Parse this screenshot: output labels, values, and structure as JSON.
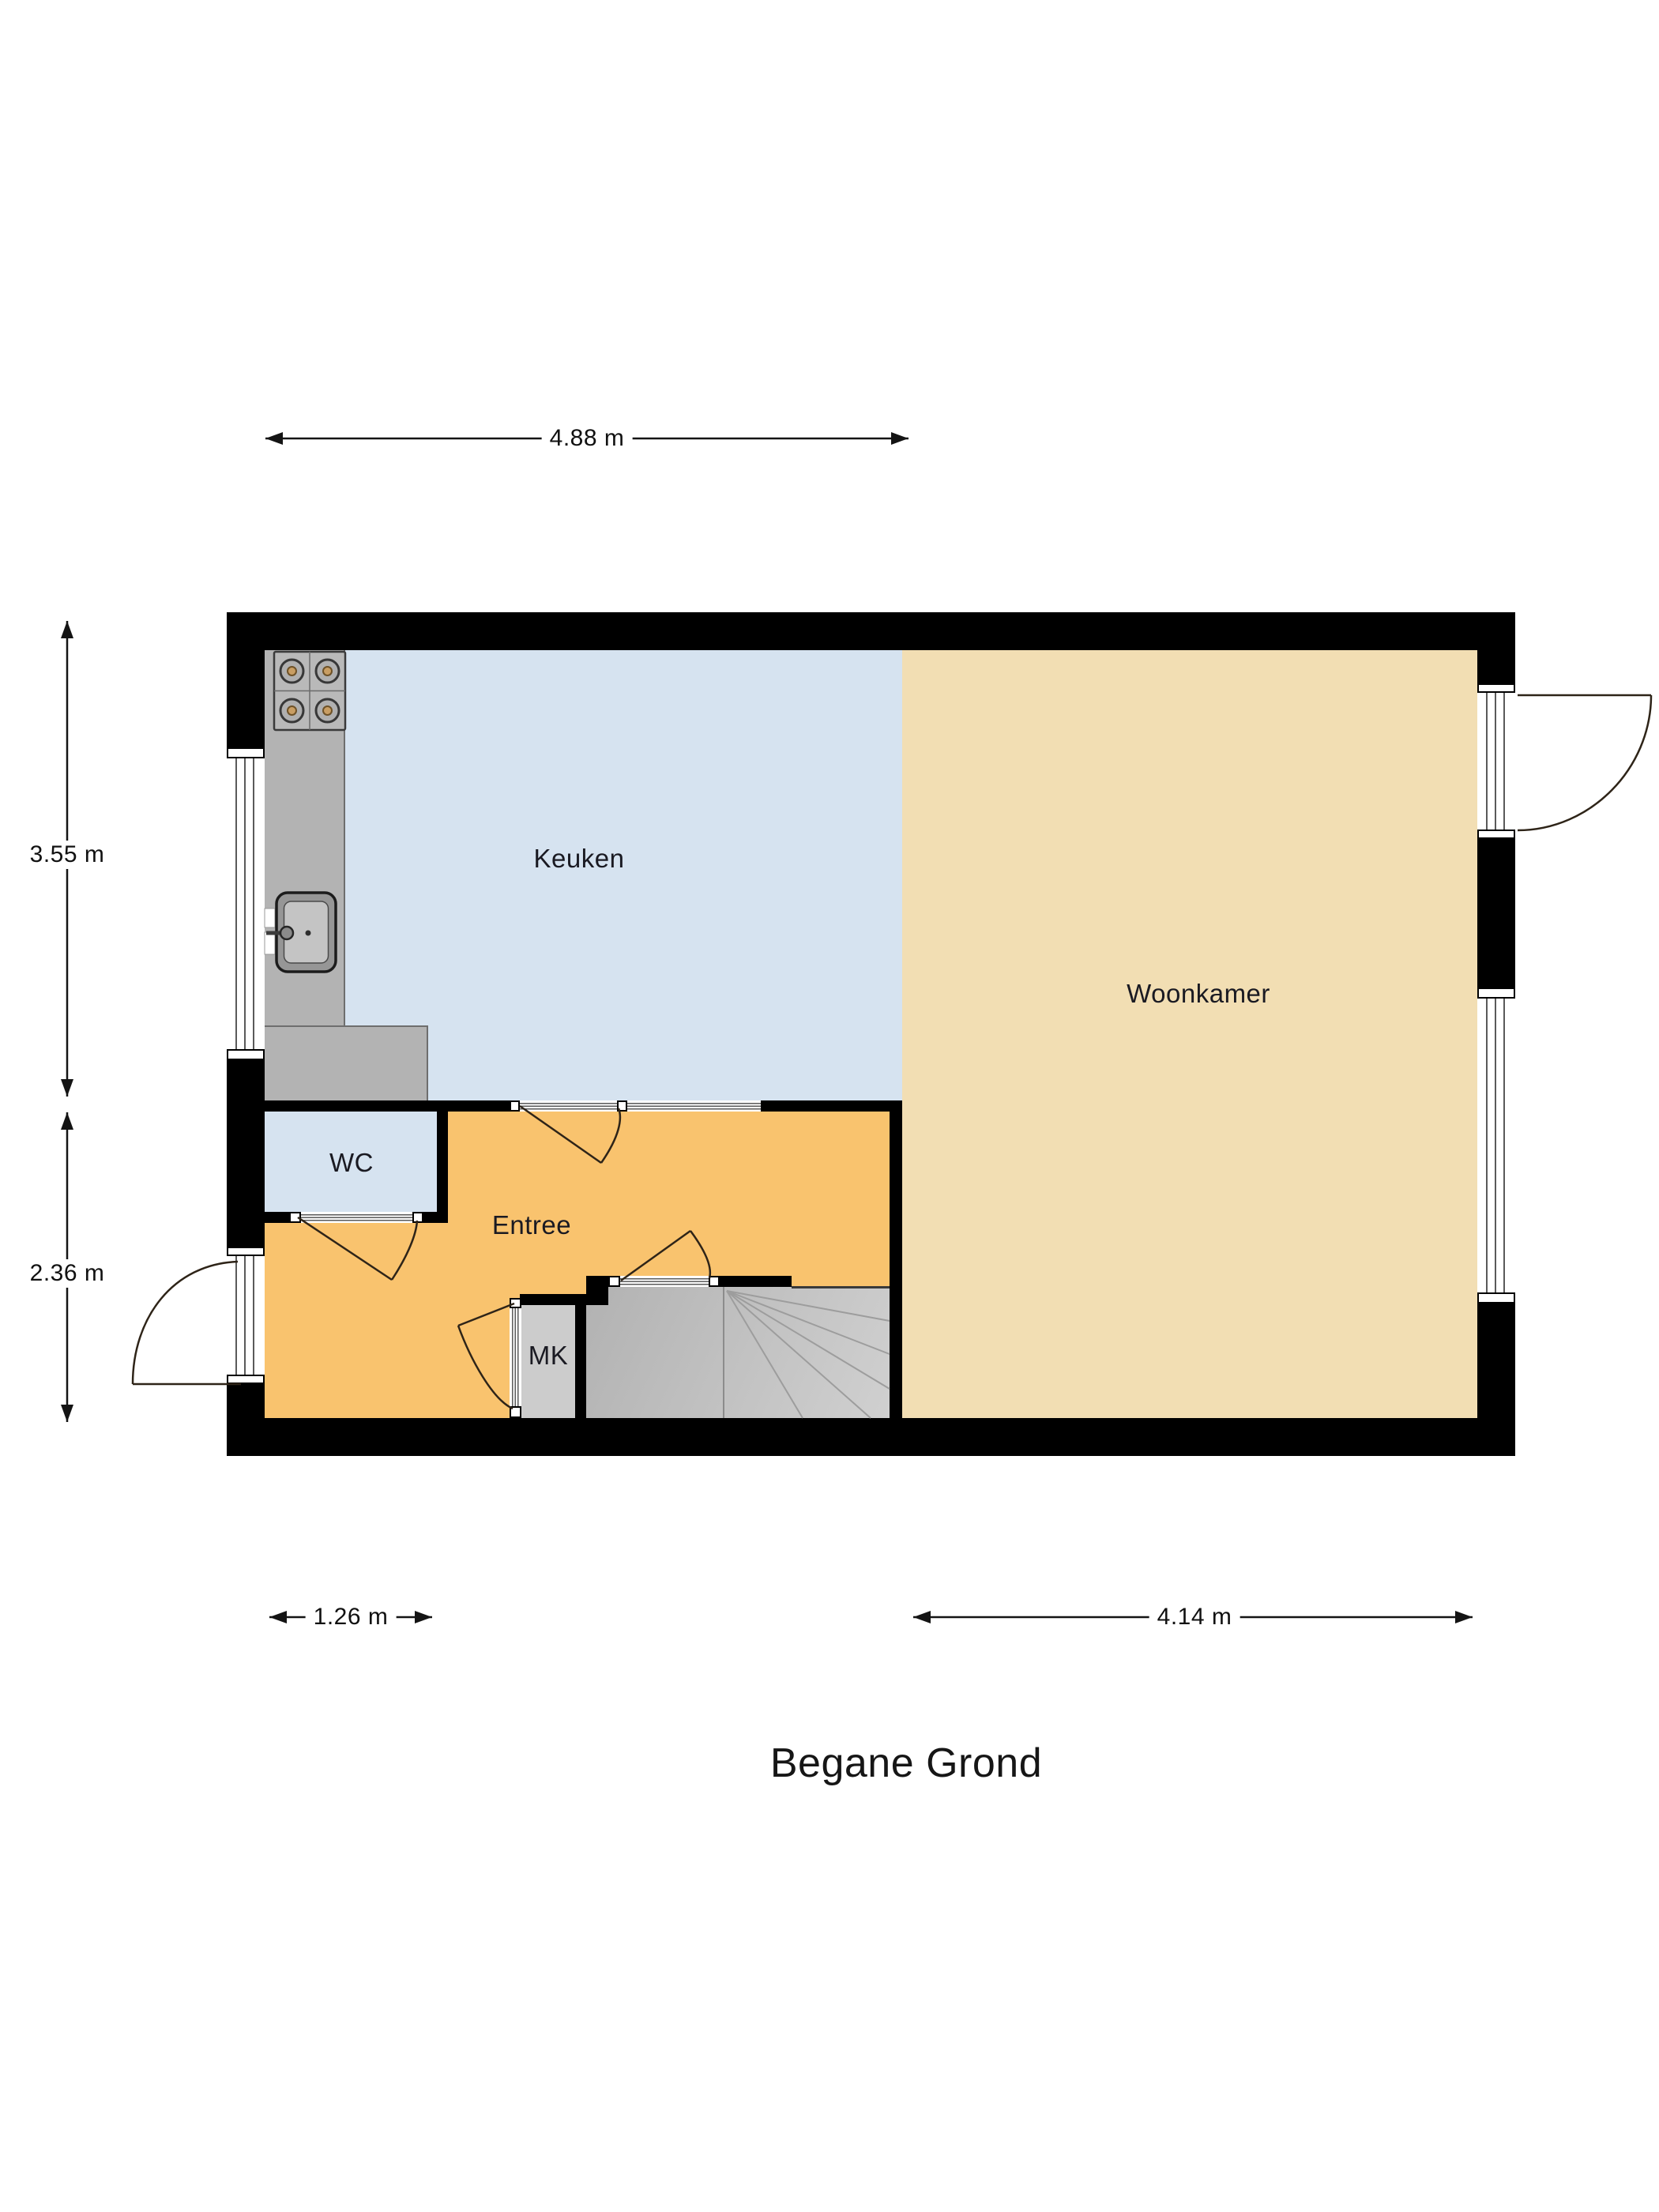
{
  "title": "Begane Grond",
  "rooms": [
    {
      "id": "keuken",
      "label": "Keuken"
    },
    {
      "id": "woonkamer",
      "label": "Woonkamer"
    },
    {
      "id": "wc",
      "label": "WC"
    },
    {
      "id": "entree",
      "label": "Entree"
    },
    {
      "id": "mk",
      "label": "MK"
    }
  ],
  "dimensions": {
    "top_width": "4.88 m",
    "left_upper_height": "3.55 m",
    "left_lower_height": "2.36 m",
    "bottom_left_width": "1.26 m",
    "bottom_right_width": "4.14 m"
  },
  "fixtures": [
    "stove",
    "kitchen-sink",
    "kitchen-counter",
    "staircase",
    "meter-closet",
    "front-door",
    "garden-door",
    "windows"
  ],
  "colors": {
    "wall": "#000000",
    "keuken_floor": "#d6e3f0",
    "woonkamer_floor": "#f2deb3",
    "entree_floor": "#f9c36e",
    "wc_floor": "#d6e3f0",
    "counter": "#b3b3b3",
    "stairs": "#c6c6c6",
    "background": "#ffffff"
  }
}
